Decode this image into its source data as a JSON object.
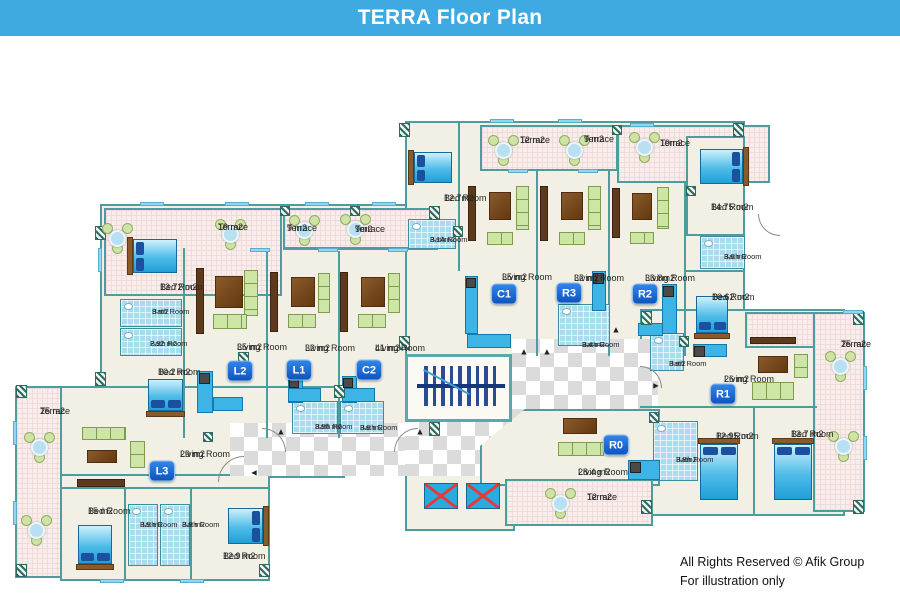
{
  "header": {
    "title": "TERRA Floor Plan",
    "bg": "#3FA9E1"
  },
  "footer": {
    "line1": "All Rights Reserved © Afik Group",
    "line2": "For illustration only"
  },
  "plan": {
    "floors": [
      {
        "id": "left-wing",
        "r": [
          100,
          168,
          340,
          234
        ],
        "z": 1
      },
      {
        "id": "l3-living-wing",
        "r": [
          60,
          350,
          285,
          92
        ],
        "z": 1
      },
      {
        "id": "l3-bedroom-wing",
        "r": [
          60,
          438,
          210,
          107
        ],
        "z": 1
      },
      {
        "id": "center-wing",
        "r": [
          405,
          85,
          340,
          235
        ],
        "z": 1
      },
      {
        "id": "bedroom-14-75-room",
        "r": [
          686,
          100,
          59,
          100
        ],
        "z": 3
      },
      {
        "id": "right-wing",
        "r": [
          640,
          273,
          205,
          207
        ],
        "z": 1
      },
      {
        "id": "r0-living-room",
        "r": [
          480,
          373,
          180,
          77
        ],
        "z": 3,
        "clip": "polygon(25% 0,100% 0,100% 100%,0 100%,0 48%)"
      },
      {
        "id": "elevator-room",
        "r": [
          405,
          437,
          110,
          58
        ],
        "z": 1
      }
    ],
    "terraces": [
      {
        "r": [
          15,
          350,
          47,
          192
        ],
        "z": 2
      },
      {
        "r": [
          104,
          172,
          178,
          88
        ],
        "z": 2
      },
      {
        "r": [
          283,
          172,
          155,
          42
        ],
        "z": 2
      },
      {
        "r": [
          480,
          89,
          138,
          46
        ],
        "z": 2
      },
      {
        "r": [
          617,
          89,
          153,
          58
        ],
        "z": 2
      },
      {
        "r": [
          745,
          276,
          118,
          36
        ],
        "z": 2
      },
      {
        "r": [
          813,
          276,
          52,
          200
        ],
        "z": 2
      },
      {
        "r": [
          505,
          443,
          148,
          47
        ],
        "z": 4
      }
    ],
    "halls": [
      [
        230,
        387,
        177,
        53
      ],
      [
        405,
        386,
        107,
        54
      ],
      [
        512,
        303,
        146,
        137
      ]
    ],
    "stairs": {
      "r": [
        405,
        318,
        107,
        68
      ],
      "bars": 9
    },
    "elevators": [
      [
        424,
        447,
        34,
        26
      ],
      [
        466,
        447,
        34,
        26
      ]
    ],
    "iwalls": [
      [
        283,
        211,
        157,
        2
      ],
      [
        183,
        212,
        2,
        190
      ],
      [
        266,
        215,
        2,
        187
      ],
      [
        338,
        215,
        2,
        187
      ],
      [
        458,
        87,
        2,
        148
      ],
      [
        536,
        135,
        2,
        185
      ],
      [
        608,
        135,
        2,
        185
      ],
      [
        684,
        147,
        2,
        173
      ],
      [
        686,
        234,
        57,
        2
      ],
      [
        640,
        370,
        177,
        2
      ],
      [
        753,
        372,
        2,
        107
      ],
      [
        62,
        451,
        206,
        2
      ],
      [
        124,
        453,
        2,
        92
      ],
      [
        190,
        453,
        2,
        92
      ]
    ],
    "baths": [
      [
        120,
        263,
        62,
        28
      ],
      [
        120,
        292,
        62,
        28
      ],
      [
        292,
        365,
        46,
        33
      ],
      [
        340,
        365,
        44,
        33
      ],
      [
        128,
        468,
        30,
        62
      ],
      [
        160,
        468,
        30,
        62
      ],
      [
        408,
        183,
        48,
        30
      ],
      [
        558,
        268,
        52,
        42
      ],
      [
        700,
        200,
        45,
        33
      ],
      [
        650,
        297,
        34,
        38
      ],
      [
        653,
        385,
        45,
        60
      ]
    ],
    "kitchens": [
      [
        197,
        335,
        16,
        42
      ],
      [
        213,
        361,
        30,
        14
      ],
      [
        288,
        340,
        15,
        27
      ],
      [
        288,
        352,
        33,
        14
      ],
      [
        342,
        340,
        15,
        27
      ],
      [
        342,
        352,
        33,
        14
      ],
      [
        465,
        240,
        13,
        58
      ],
      [
        467,
        298,
        44,
        14
      ],
      [
        592,
        235,
        14,
        40
      ],
      [
        662,
        248,
        15,
        50
      ],
      [
        638,
        287,
        25,
        13
      ],
      [
        693,
        308,
        34,
        13
      ],
      [
        628,
        424,
        32,
        20
      ]
    ],
    "appliances": [
      [
        199,
        337,
        11,
        11
      ],
      [
        289,
        342,
        10,
        10
      ],
      [
        343,
        342,
        10,
        10
      ],
      [
        466,
        242,
        10,
        10
      ],
      [
        593,
        237,
        11,
        11
      ],
      [
        663,
        250,
        11,
        11
      ],
      [
        694,
        310,
        11,
        11
      ],
      [
        630,
        426,
        11,
        11
      ]
    ],
    "beds": [
      [
        133,
        203,
        44,
        34,
        "l"
      ],
      [
        148,
        343,
        35,
        32,
        "b"
      ],
      [
        78,
        489,
        34,
        39,
        "b"
      ],
      [
        228,
        472,
        35,
        36,
        "r"
      ],
      [
        414,
        116,
        38,
        31,
        "l"
      ],
      [
        700,
        113,
        43,
        35,
        "r"
      ],
      [
        696,
        260,
        32,
        37,
        "b"
      ],
      [
        700,
        408,
        38,
        56,
        "t"
      ],
      [
        774,
        408,
        38,
        56,
        "t"
      ]
    ],
    "tvs": [
      [
        196,
        232,
        8,
        66
      ],
      [
        270,
        236,
        8,
        60
      ],
      [
        340,
        236,
        8,
        60
      ],
      [
        468,
        150,
        8,
        55
      ],
      [
        540,
        150,
        8,
        55
      ],
      [
        612,
        152,
        8,
        50
      ],
      [
        750,
        301,
        46,
        7
      ],
      [
        77,
        443,
        48,
        8
      ]
    ],
    "wood_tables": [
      [
        215,
        240,
        28,
        32
      ],
      [
        291,
        241,
        24,
        30
      ],
      [
        361,
        241,
        24,
        30
      ],
      [
        489,
        156,
        22,
        28
      ],
      [
        561,
        156,
        22,
        28
      ],
      [
        632,
        157,
        20,
        27
      ],
      [
        758,
        320,
        30,
        17
      ],
      [
        87,
        414,
        30,
        13
      ],
      [
        563,
        382,
        34,
        16
      ]
    ],
    "sofas3": [
      [
        244,
        234,
        14,
        46
      ],
      [
        318,
        237,
        12,
        40
      ],
      [
        388,
        237,
        12,
        40
      ],
      [
        516,
        150,
        13,
        44
      ],
      [
        588,
        150,
        13,
        44
      ],
      [
        657,
        151,
        12,
        42
      ],
      [
        752,
        346,
        42,
        18
      ],
      [
        558,
        406,
        46,
        14
      ],
      [
        82,
        391,
        44,
        13
      ]
    ],
    "sofas2": [
      [
        213,
        278,
        34,
        15
      ],
      [
        288,
        278,
        28,
        14
      ],
      [
        358,
        278,
        28,
        14
      ],
      [
        487,
        196,
        26,
        13
      ],
      [
        559,
        196,
        26,
        13
      ],
      [
        630,
        196,
        24,
        12
      ],
      [
        794,
        318,
        14,
        24
      ],
      [
        130,
        405,
        15,
        27
      ]
    ],
    "round_tables": [
      [
        118,
        203
      ],
      [
        231,
        199
      ],
      [
        305,
        195
      ],
      [
        356,
        194
      ],
      [
        40,
        412
      ],
      [
        37,
        495
      ],
      [
        504,
        115
      ],
      [
        575,
        115
      ],
      [
        645,
        112
      ],
      [
        841,
        331
      ],
      [
        844,
        411
      ],
      [
        561,
        468
      ]
    ],
    "hatches": [
      [
        95,
        190,
        11,
        14
      ],
      [
        95,
        336,
        11,
        14
      ],
      [
        429,
        170,
        11,
        14
      ],
      [
        429,
        386,
        11,
        14
      ],
      [
        399,
        87,
        11,
        14
      ],
      [
        399,
        300,
        11,
        14
      ],
      [
        733,
        87,
        11,
        14
      ],
      [
        641,
        275,
        11,
        14
      ],
      [
        853,
        275,
        11,
        14
      ],
      [
        853,
        464,
        11,
        14
      ],
      [
        641,
        464,
        11,
        14
      ],
      [
        16,
        349,
        11,
        13
      ],
      [
        16,
        528,
        11,
        13
      ],
      [
        334,
        349,
        11,
        13
      ],
      [
        259,
        528,
        11,
        13
      ],
      [
        238,
        316,
        11,
        11
      ],
      [
        453,
        190,
        10,
        11
      ],
      [
        679,
        300,
        10,
        11
      ],
      [
        649,
        376,
        10,
        11
      ],
      [
        203,
        396,
        10,
        10
      ],
      [
        280,
        170,
        10,
        10
      ],
      [
        350,
        170,
        10,
        10
      ],
      [
        612,
        89,
        10,
        10
      ],
      [
        686,
        150,
        10,
        10
      ]
    ],
    "windows": [
      [
        140,
        166,
        24,
        4
      ],
      [
        225,
        166,
        24,
        4
      ],
      [
        305,
        166,
        24,
        4
      ],
      [
        372,
        166,
        24,
        4
      ],
      [
        490,
        83,
        24,
        4
      ],
      [
        558,
        83,
        24,
        4
      ],
      [
        630,
        87,
        24,
        4
      ],
      [
        98,
        212,
        4,
        24
      ],
      [
        13,
        385,
        4,
        24
      ],
      [
        13,
        465,
        4,
        24
      ],
      [
        100,
        543,
        24,
        4
      ],
      [
        180,
        543,
        24,
        4
      ],
      [
        250,
        212,
        20,
        4
      ],
      [
        318,
        212,
        20,
        4
      ],
      [
        388,
        212,
        20,
        4
      ],
      [
        508,
        133,
        20,
        4
      ],
      [
        578,
        133,
        20,
        4
      ],
      [
        843,
        274,
        20,
        4
      ],
      [
        863,
        330,
        4,
        24
      ],
      [
        863,
        400,
        4,
        24
      ]
    ],
    "arcs": [
      [
        218,
        420,
        26,
        26,
        "tl"
      ],
      [
        262,
        392,
        24,
        24,
        "tr"
      ],
      [
        394,
        392,
        24,
        24,
        "tl"
      ],
      [
        640,
        330,
        22,
        22,
        "tr"
      ],
      [
        758,
        178,
        22,
        22,
        "bl"
      ]
    ],
    "arrows": [
      {
        "x": 281,
        "y": 396,
        "d": "u"
      },
      {
        "x": 420,
        "y": 396,
        "d": "u"
      },
      {
        "x": 524,
        "y": 316,
        "d": "u"
      },
      {
        "x": 547,
        "y": 316,
        "d": "u"
      },
      {
        "x": 616,
        "y": 294,
        "d": "u"
      },
      {
        "x": 254,
        "y": 437,
        "d": "l"
      },
      {
        "x": 656,
        "y": 350,
        "d": "r"
      }
    ],
    "rooms": [
      {
        "name": "Terrace",
        "area": "19 m2",
        "x": 218,
        "y": 186,
        "size": "n"
      },
      {
        "name": "Terrace",
        "area": "9 m2",
        "x": 287,
        "y": 187,
        "size": "n"
      },
      {
        "name": "Terrace",
        "area": "9m2",
        "x": 355,
        "y": 188,
        "size": "n"
      },
      {
        "name": "Bed Room",
        "area": "13.72 m2",
        "x": 160,
        "y": 246,
        "size": "n"
      },
      {
        "name": "Bath Room",
        "area": "3 m2",
        "x": 152,
        "y": 272,
        "size": "s"
      },
      {
        "name": "Bath Room",
        "area": "2.92 m2",
        "x": 150,
        "y": 304,
        "size": "s"
      },
      {
        "name": "Bed Room",
        "area": "10.2 m2",
        "x": 158,
        "y": 331,
        "size": "n"
      },
      {
        "name": "Living Room",
        "area": "35  m2",
        "x": 237,
        "y": 306,
        "size": "n"
      },
      {
        "name": "Living Room",
        "area": "32  m2",
        "x": 305,
        "y": 307,
        "size": "n"
      },
      {
        "name": "Living Room",
        "area": "41  m2",
        "x": 375,
        "y": 307,
        "size": "n"
      },
      {
        "name": "Bath Room",
        "area": "3.56 m2",
        "x": 315,
        "y": 387,
        "size": "s"
      },
      {
        "name": "Bath Room",
        "area": "3.6 m2",
        "x": 360,
        "y": 388,
        "size": "s"
      },
      {
        "name": "Terrace",
        "area": "25 m2",
        "x": 40,
        "y": 370,
        "size": "n"
      },
      {
        "name": "Living Room",
        "area": "29 m2",
        "x": 180,
        "y": 413,
        "size": "n"
      },
      {
        "name": "Bed Room",
        "area": "15 m2",
        "x": 88,
        "y": 470,
        "size": "n"
      },
      {
        "name": "Bath Room",
        "area": "3.5 m2",
        "x": 140,
        "y": 485,
        "size": "s"
      },
      {
        "name": "Bath Room",
        "area": "3.8 m2",
        "x": 182,
        "y": 485,
        "size": "s"
      },
      {
        "name": "Bed Room",
        "area": "12.9  m2",
        "x": 223,
        "y": 515,
        "size": "n"
      },
      {
        "name": "Bed Room",
        "area": "12.7m2",
        "x": 444,
        "y": 157,
        "size": "n"
      },
      {
        "name": "Terrace",
        "area": "12 m2",
        "x": 520,
        "y": 99,
        "size": "n"
      },
      {
        "name": "Terrace",
        "area": "9 m2",
        "x": 584,
        "y": 98,
        "size": "n"
      },
      {
        "name": "Bath Room",
        "area": "3.14m2",
        "x": 430,
        "y": 200,
        "size": "s"
      },
      {
        "name": "Living Room",
        "area": "35  m2",
        "x": 502,
        "y": 236,
        "size": "n"
      },
      {
        "name": "Living Room",
        "area": "32 m2",
        "x": 574,
        "y": 237,
        "size": "n"
      },
      {
        "name": "Bath Room",
        "area": "3.4 m2",
        "x": 582,
        "y": 305,
        "size": "s"
      },
      {
        "name": "Living Room",
        "area": "33.8m2",
        "x": 645,
        "y": 237,
        "size": "n"
      },
      {
        "name": "Terrace",
        "area": "19m2",
        "x": 660,
        "y": 102,
        "size": "n"
      },
      {
        "name": "Bed Room",
        "area": "14.75 m2",
        "x": 711,
        "y": 166,
        "size": "n"
      },
      {
        "name": "Bath Room",
        "area": "3.6 m2",
        "x": 724,
        "y": 217,
        "size": "s"
      },
      {
        "name": "Bed Room",
        "area": "10.62 m2",
        "x": 712,
        "y": 256,
        "size": "n"
      },
      {
        "name": "Bath Room",
        "area": "3 m2",
        "x": 669,
        "y": 324,
        "size": "s"
      },
      {
        "name": "Living Room",
        "area": "26 m2",
        "x": 724,
        "y": 338,
        "size": "n"
      },
      {
        "name": "Terrace",
        "area": "25 m2",
        "x": 841,
        "y": 303,
        "size": "n"
      },
      {
        "name": "Bed Room",
        "area": "12.95 m2",
        "x": 716,
        "y": 395,
        "size": "n"
      },
      {
        "name": "Bed Room",
        "area": "13.7 m2",
        "x": 791,
        "y": 393,
        "size": "n"
      },
      {
        "name": "Bath Room",
        "area": "3.8m2",
        "x": 676,
        "y": 420,
        "size": "s"
      },
      {
        "name": "Living Room",
        "area": "28.4 m2",
        "x": 578,
        "y": 431,
        "size": "n"
      },
      {
        "name": "Terrace",
        "area": "12 m2",
        "x": 587,
        "y": 456,
        "size": "n"
      }
    ],
    "badges": [
      {
        "id": "L2",
        "x": 240,
        "y": 335
      },
      {
        "id": "L1",
        "x": 299,
        "y": 334
      },
      {
        "id": "C2",
        "x": 369,
        "y": 334
      },
      {
        "id": "L3",
        "x": 162,
        "y": 435
      },
      {
        "id": "C1",
        "x": 504,
        "y": 258
      },
      {
        "id": "R3",
        "x": 569,
        "y": 257
      },
      {
        "id": "R2",
        "x": 645,
        "y": 258
      },
      {
        "id": "R1",
        "x": 723,
        "y": 358
      },
      {
        "id": "R0",
        "x": 616,
        "y": 409
      }
    ]
  }
}
